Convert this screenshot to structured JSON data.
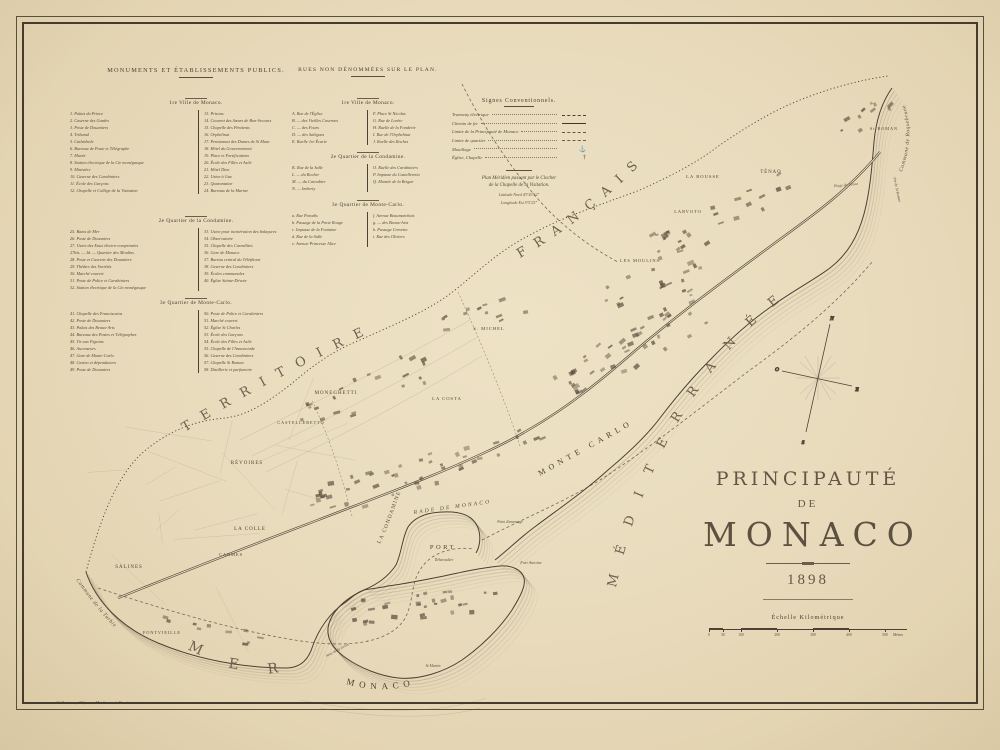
{
  "legend_monuments": {
    "title": "MONUMENTS ET ÉTABLISSEMENTS PUBLICS.",
    "sections": [
      {
        "heading": "1re Ville de Monaco.",
        "col1": [
          "1. Palais du Prince",
          "2. Caserne des Gardes",
          "3. Poste de Douaniers",
          "4. Tribunal",
          "5. Cathédrale",
          "6. Bureaux de Poste et Télégraphe",
          "7. Musée",
          "8. Station électrique de la Cie monégasque",
          "9. Ministère",
          "10. Caserne des Carabiniers",
          "11. École des Garçons",
          "12. Chapelle et Collège de la Visitation"
        ],
        "col2": [
          "13. Prisons",
          "14. Couvent des Sœurs de Bon-Secours",
          "15. Chapelle des Pénitents",
          "16. Orphelinat",
          "17. Pensionnat des Dames de St Maur",
          "18. Hôtel du Gouvernement",
          "19. Place et Fortifications",
          "20. École des Filles et Asile",
          "21. Hôtel Dieu",
          "22. Usine à Gaz",
          "23. Quarantaine",
          "24. Bureaux de la Marine"
        ]
      },
      {
        "heading": "2e Quartier de la Condamine.",
        "col1": [
          "25. Bains de Mer",
          "26. Poste de Douaniers",
          "27. Usine des Eaux électro-comprimées",
          "27bis. — Id. — Quartier des Moulins",
          "28. Poste et Caserne des Douaniers",
          "29. Théâtre des Variétés",
          "30. Marché couvert",
          "31. Poste de Police et Carabiniers",
          "32. Station électrique de la Cie monégasque"
        ],
        "col2": [
          "33. Usine pour incinération des balayures",
          "34. Observatoire",
          "35. Chapelle des Carmélites",
          "36. Gare de Monaco",
          "37. Bureau central du Téléphone",
          "38. Caserne des Carabiniers",
          "39. Écoles communales",
          "40. Église Sainte-Dévote"
        ]
      },
      {
        "heading": "3e Quartier de Monte-Carlo.",
        "col1": [
          "41. Chapelle des Franciscains",
          "42. Poste de Douaniers",
          "43. Palais des Beaux-Arts",
          "44. Bureaux des Postes et Télégraphes",
          "45. Tir aux Pigeons",
          "46. Ascenseurs",
          "47. Gare de Monte-Carlo",
          "48. Casino et dépendances",
          "49. Poste de Douaniers"
        ],
        "col2": [
          "50. Poste de Police et Carabiniers",
          "51. Marché couvert",
          "52. Église St Charles",
          "53. École des Garçons",
          "54. École des Filles et Asile",
          "55. Chapelle de l'Annonciade",
          "56. Caserne des Carabiniers",
          "57. Chapelle St Roman",
          "58. Distillerie et parfumerie"
        ]
      }
    ]
  },
  "legend_rues": {
    "title": "RUES NON DÉNOMMÉES SUR LE PLAN.",
    "sections": [
      {
        "heading": "1re Ville de Monaco.",
        "col1": [
          "A. Rue de l'Église",
          "B. — des Vieilles Casernes",
          "C. — des Fours",
          "D. — des Salègues",
          "E. Ruelle 1re Écurie"
        ],
        "col2": [
          "F. Place St Nicolas",
          "G. Rue de Lorète",
          "H. Ruelle de la Fonderie",
          "I. Rue de l'Orphelinat",
          "J. Ruelle des Roches"
        ]
      },
      {
        "heading": "2e Quartier de la Condamine.",
        "col1": [
          "K. Rue de la Salle",
          "L. — du Rocher",
          "M. — du Caroubier",
          "N. — Imberty"
        ],
        "col2": [
          "O. Ruelle des Carabiniers",
          "P. Impasse du Castelleretto",
          "Q. Montée de la Brigue"
        ]
      },
      {
        "heading": "3e Quartier de Monte-Carlo.",
        "col1": [
          "a. Rue Paradis",
          "b. Passage de la Porte Rouge",
          "c. Impasse de la Fontaine",
          "d. Rue de la Salle",
          "e. Avenue Princesse Alice"
        ],
        "col2": [
          "f. Avenue Beaumarchais",
          "g. — des Beaux-Arts",
          "h. Passage Crovetto",
          "i. Rue des Oliviers"
        ]
      }
    ]
  },
  "signes": {
    "title": "Signes Conventionnels.",
    "items": [
      {
        "label": "Tramway électrique"
      },
      {
        "label": "Chemin de fer"
      },
      {
        "label": "Limite de la Principauté de Monaco"
      },
      {
        "label": "Limite de quartier"
      },
      {
        "label": "Mouillage",
        "glyph": "⚓"
      },
      {
        "label": "Église, Chapelle",
        "glyph": "†"
      }
    ],
    "meridian_l1": "Plan Méridien passant par le Clocher",
    "meridian_l2": "de la Chapelle de la Visitation.",
    "lat": "Latitude Nord 43°43′52″",
    "lon": "Longitude Est 5°5′23″"
  },
  "title_block": {
    "l1": "PRINCIPAUTÉ",
    "l2": "DE",
    "l3": "MONACO",
    "year": "1898"
  },
  "scale": {
    "label": "Échelle Kilométrique",
    "ticks": [
      "0",
      "50",
      "100",
      "200",
      "300",
      "400",
      "500"
    ],
    "unit": "Mètres"
  },
  "imprint": "Gillot sc., 39, rue Madame à Paris.",
  "sea": {
    "territoire": "TERRITOIRE",
    "francais": "FRANÇAIS",
    "mediterranee": "MÉDITERRANÉE",
    "mer": "MER",
    "monte_carlo": "MONTE CARLO",
    "rade": "RADE DE MONACO",
    "port": "PORT",
    "monaco": "MONACO"
  },
  "bounds": {
    "turbie": "Commune de la Turbie",
    "roquebrune": "Commune de Roquebrune"
  },
  "compass": {
    "n": "N",
    "s": "S",
    "e": "E",
    "o": "O"
  },
  "map_labels": {
    "districts": [
      {
        "t": "MONEGHETTI",
        "x": 336,
        "y": 394,
        "s": 5
      },
      {
        "t": "CASTELLERETTO",
        "x": 301,
        "y": 424,
        "s": 4.2
      },
      {
        "t": "RÉVOIRES",
        "x": 247,
        "y": 464,
        "s": 5
      },
      {
        "t": "LA COLLE",
        "x": 250,
        "y": 530,
        "s": 5
      },
      {
        "t": "CARMES",
        "x": 231,
        "y": 556,
        "s": 4.4
      },
      {
        "t": "SALINES",
        "x": 129,
        "y": 568,
        "s": 5
      },
      {
        "t": "FONTVIEILLE",
        "x": 162,
        "y": 634,
        "s": 4.2
      },
      {
        "t": "LA COSTA",
        "x": 447,
        "y": 400,
        "s": 4.6
      },
      {
        "t": "S. MICHEL",
        "x": 489,
        "y": 330,
        "s": 4.6
      },
      {
        "t": "LES MOULINS",
        "x": 640,
        "y": 262,
        "s": 4.4
      },
      {
        "t": "LA ROUSSE",
        "x": 703,
        "y": 178,
        "s": 4.6
      },
      {
        "t": "LARVOTO",
        "x": 688,
        "y": 213,
        "s": 4.4
      },
      {
        "t": "TÉNAO",
        "x": 771,
        "y": 173,
        "s": 4.8,
        "ls": 2
      },
      {
        "t": "St ROMAN",
        "x": 884,
        "y": 130,
        "s": 4.2
      }
    ],
    "minor": [
      {
        "t": "Fort Antoine",
        "x": 531,
        "y": 564,
        "s": 4.2
      },
      {
        "t": "St Martin",
        "x": 433,
        "y": 667,
        "s": 3.9
      },
      {
        "t": "Débarcadère",
        "x": 444,
        "y": 561,
        "s": 3.6
      },
      {
        "t": "Point d'amarrage",
        "x": 510,
        "y": 523,
        "s": 3.6
      },
      {
        "t": "Anse de la Grève",
        "x": 338,
        "y": 651,
        "s": 3.8,
        "r": -28
      },
      {
        "t": "Plage du Ténao",
        "x": 846,
        "y": 186,
        "s": 3.8,
        "r": -6
      },
      {
        "t": "Pte de St Roman",
        "x": 896,
        "y": 190,
        "s": 3.8,
        "r": 78
      }
    ]
  }
}
